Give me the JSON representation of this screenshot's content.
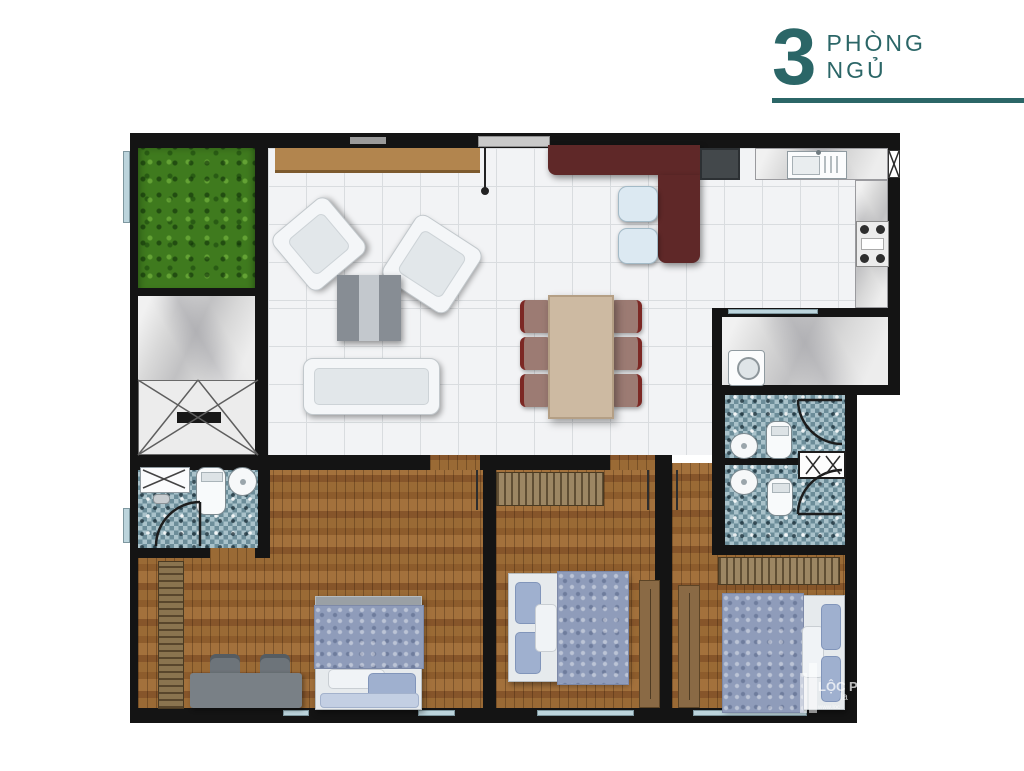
{
  "heading": {
    "number": "3",
    "line1": "PHÒNG",
    "line2": "NGỦ",
    "accent_color": "#2b6667"
  },
  "watermark": {
    "line1": "LỘC P",
    "line2": "la",
    "line3": "www.loc"
  },
  "floorplan": {
    "type": "apartment-floor-plan",
    "bedrooms_count": "3",
    "rooms": [
      "balcony-garden",
      "terrace",
      "stairwell",
      "living-room",
      "dining-area",
      "kitchen",
      "laundry-room",
      "bathroom-1",
      "bathroom-2",
      "bathroom-3",
      "hall",
      "bedroom-1",
      "bedroom-2",
      "bedroom-3"
    ],
    "colors": {
      "wall": "#141414",
      "tile_floor": "#f2f3f5",
      "wood_floor": "#95632f",
      "grass": "#3f7a1e",
      "marble": "#d8d8d8",
      "mosaic_light": "#a9c2ca",
      "mosaic_dark": "#6c8d99",
      "bar_counter": "#5f2828",
      "console_wood": "#b2854e",
      "dining_table": "#cdbaa2",
      "dining_chair": "#9c7b73",
      "chair_accent": "#7c2824",
      "stool": "#dce9f2",
      "duvet_blue": "#8f9cba",
      "pillow_blue": "#9fb0cf",
      "window_glass": "#bcd4dc",
      "desk_gray": "#798086"
    }
  }
}
